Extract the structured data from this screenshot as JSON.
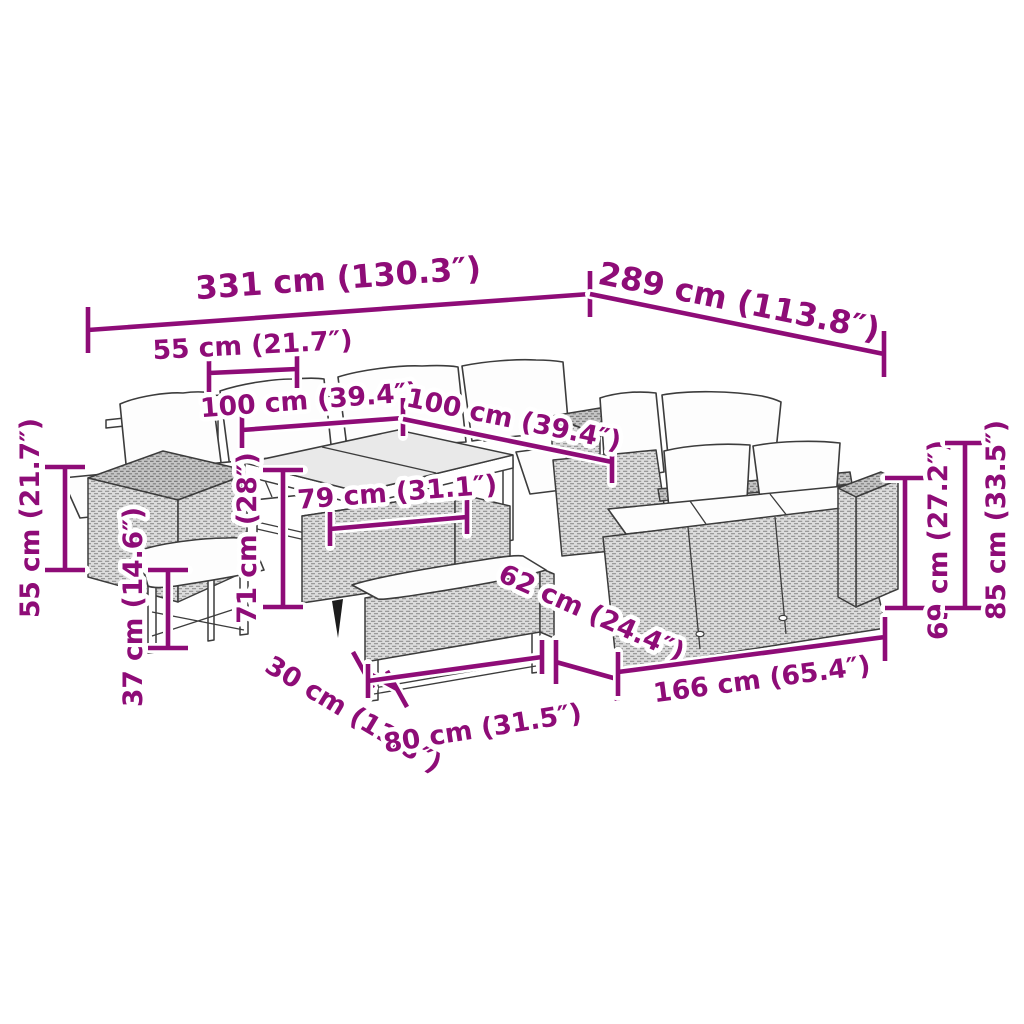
{
  "diagram": {
    "type": "furniture-dimension-diagram",
    "product": "garden-rattan-lounge-set",
    "colors": {
      "dimension": "#8e0c77",
      "drawing_line": "#3c3c3c",
      "rattan_fill": "#dcdcdc",
      "background": "#ffffff"
    },
    "scene": {
      "parts": [
        "back-left-sofa",
        "back-middle-sofa",
        "corner-sofa-unit",
        "right-sofa",
        "left-storage-cube",
        "right-arm-cube",
        "dining-table",
        "footstool",
        "bench"
      ]
    },
    "dimensions": [
      {
        "id": "overall-width",
        "label": "331 cm (130.3″)",
        "cm": 331,
        "inches": 130.3
      },
      {
        "id": "overall-depth",
        "label": "289 cm (113.8″)",
        "cm": 289,
        "inches": 113.8
      },
      {
        "id": "cube-width",
        "label": "55 cm (21.7″)",
        "cm": 55,
        "inches": 21.7
      },
      {
        "id": "table-width",
        "label": "100 cm (39.4″)",
        "cm": 100,
        "inches": 39.4
      },
      {
        "id": "table-depth",
        "label": "100 cm (39.4″)",
        "cm": 100,
        "inches": 39.4
      },
      {
        "id": "table-inner-width",
        "label": "79 cm (31.1″)",
        "cm": 79,
        "inches": 31.1
      },
      {
        "id": "table-height",
        "label": "71 cm (28″)",
        "cm": 71,
        "inches": 28
      },
      {
        "id": "cube-height",
        "label": "55 cm (21.7″)",
        "cm": 55,
        "inches": 21.7
      },
      {
        "id": "footstool-height",
        "label": "37 cm (14.6″)",
        "cm": 37,
        "inches": 14.6
      },
      {
        "id": "footstool-depth",
        "label": "30 cm (11.8″)",
        "cm": 30,
        "inches": 11.8
      },
      {
        "id": "bench-width",
        "label": "80 cm (31.5″)",
        "cm": 80,
        "inches": 31.5
      },
      {
        "id": "sofa-depth",
        "label": "62 cm (24.4″)",
        "cm": 62,
        "inches": 24.4
      },
      {
        "id": "sofa-width",
        "label": "166 cm (65.4″)",
        "cm": 166,
        "inches": 65.4
      },
      {
        "id": "arm-height",
        "label": "69 cm (27.2″)",
        "cm": 69,
        "inches": 27.2
      },
      {
        "id": "back-height",
        "label": "85 cm (33.5″)",
        "cm": 85,
        "inches": 33.5
      }
    ]
  }
}
